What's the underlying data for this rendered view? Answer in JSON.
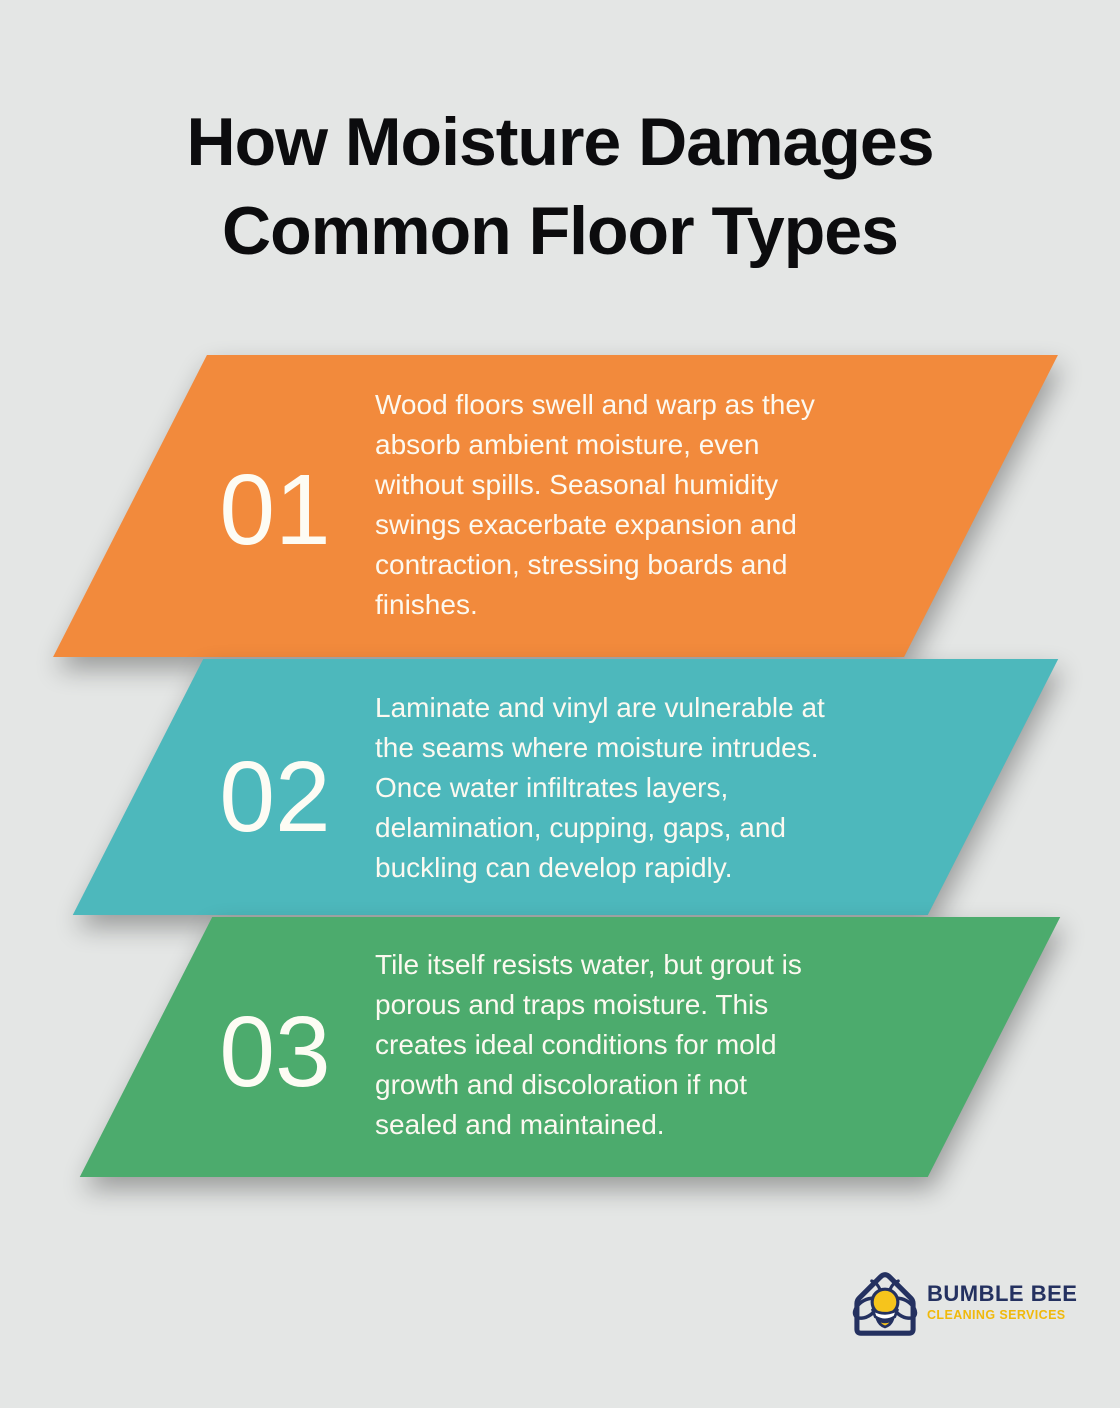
{
  "title": {
    "line1": "How Moisture Damages",
    "line2": "Common Floor Types"
  },
  "sections": [
    {
      "number": "01",
      "color": "#F28A3C",
      "lines": [
        "Wood floors swell and warp as they",
        "absorb ambient moisture, even",
        "without spills. Seasonal humidity",
        "swings exacerbate expansion and",
        "contraction, stressing boards and",
        "finishes."
      ]
    },
    {
      "number": "02",
      "color": "#4DB8BC",
      "lines": [
        "Laminate and vinyl are vulnerable at",
        "the seams where moisture intrudes.",
        "Once water infiltrates layers,",
        "delamination, cupping, gaps, and",
        "buckling can develop rapidly."
      ]
    },
    {
      "number": "03",
      "color": "#4CAB6D",
      "lines": [
        "Tile itself resists water, but grout is",
        "porous and traps moisture. This",
        "creates ideal conditions for mold",
        "growth and discoloration if not",
        "sealed and maintained."
      ]
    }
  ],
  "logo": {
    "name": "BUMBLE BEE",
    "tagline": "CLEANING SERVICES",
    "navy": "#243160",
    "yellow": "#F0B90B",
    "bee_gold": "#F6C41C"
  },
  "style": {
    "background": "#E4E6E5",
    "title_color": "#0C0C0E",
    "body_text_color": "#FCF9F0"
  }
}
